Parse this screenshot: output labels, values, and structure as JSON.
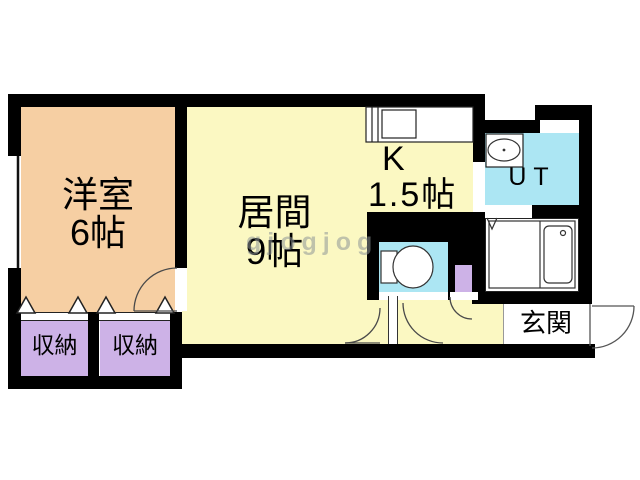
{
  "watermark": "gjogjog",
  "colors": {
    "wall": "#000000",
    "western_room_floor": "#f6cfa3",
    "living_floor": "#fbf8c2",
    "storage_floor": "#cdb2e7",
    "wet_area_floor": "#ace6f3",
    "mini_cabinet": "#cdb2e7",
    "fixture_line": "#333333"
  },
  "rooms": {
    "western": {
      "label": "洋室",
      "size": "6帖"
    },
    "living": {
      "label": "居間",
      "size": "9帖"
    },
    "kitchen": {
      "label": "K",
      "size": "1.5帖"
    },
    "utility": {
      "label": "UT"
    },
    "storage_left": {
      "label": "収納"
    },
    "storage_right": {
      "label": "収納"
    },
    "entrance": {
      "label": "玄関"
    }
  }
}
